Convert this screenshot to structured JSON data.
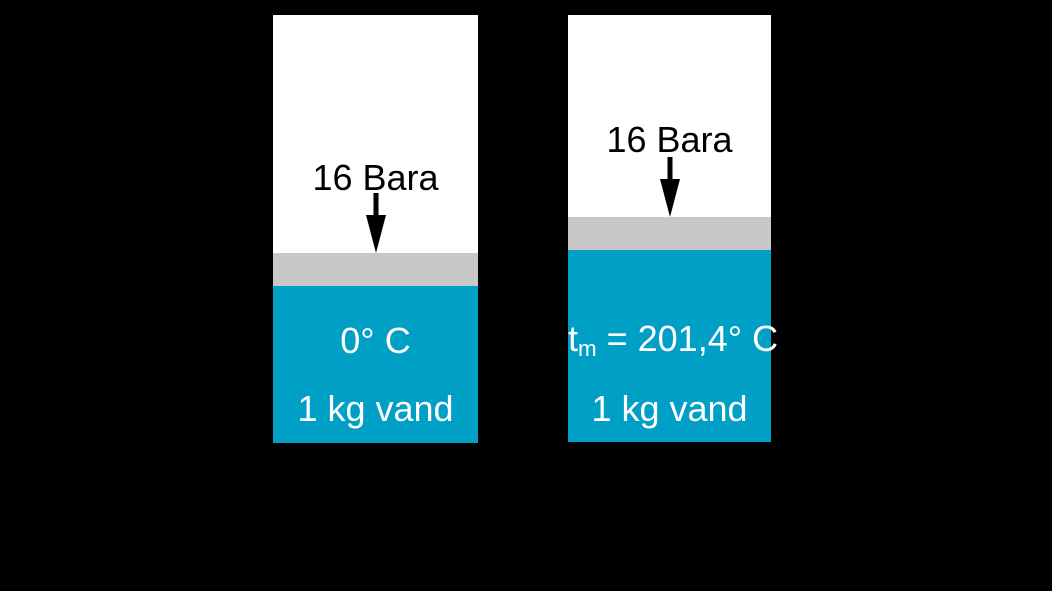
{
  "figure": {
    "background": "#000000",
    "colors": {
      "background": "#000000",
      "vessel": "#ffffff",
      "piston": "#c8c8c8",
      "water": "#009fc6",
      "pressure_text": "#000000",
      "water_text": "#ffffff"
    },
    "cylinders": [
      {
        "id": "cold-water-cylinder",
        "pressure_label": "16 Bara",
        "temperature_label": "0° C",
        "mass_label": "1 kg vand"
      },
      {
        "id": "heated-water-cylinder",
        "pressure_label": "16 Bara",
        "temperature_prefix": "t",
        "temperature_subscript": "m",
        "temperature_rest": " = 201,4° C",
        "mass_label": "1 kg vand"
      }
    ],
    "icons": {
      "pressure_arrow": "down-arrow-icon"
    }
  }
}
